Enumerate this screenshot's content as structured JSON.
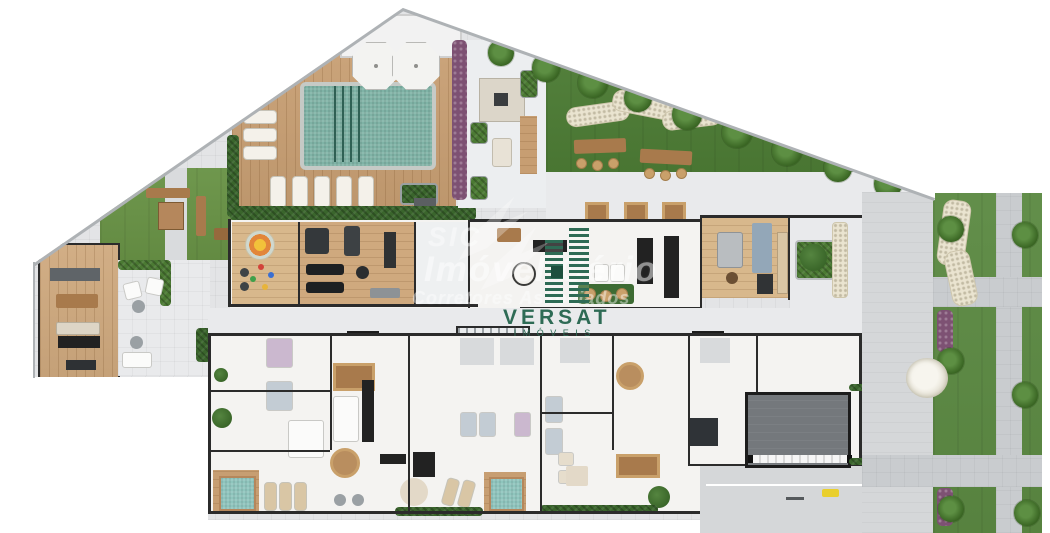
{
  "plan": {
    "watermark": {
      "line1": "SIC",
      "line2": "Imóvel Cério",
      "line3": "Corretores Associados",
      "opacity": "0.45"
    },
    "brand": {
      "name": "VERSAT",
      "subtitle": "I M Ó V E I S",
      "color": "#2e6b55"
    },
    "palette": {
      "paving": "#e3e4e6",
      "terrace": "#e9eaec",
      "lobby": "#eef0f1",
      "deck_wood": "#c79e72",
      "wood_floor": "#cfa97e",
      "wood_floor_light": "#d8b88c",
      "pool_water": "#7fb3a6",
      "plunge_water": "#8fc5bd",
      "lane_line": "#2f6054",
      "lawn": "#699346",
      "lawn_dark": "#4b7a33",
      "street_lawn": "#5c8a43",
      "hedge": "#3a652c",
      "purple_hedge": "#7d5173",
      "room_floor": "#f4f3f1",
      "wall": "#2b2b2b",
      "path_concrete": "#c9cccf",
      "road": "#d5d7d9",
      "ramp_slab": "#74787c",
      "stone_path": "#eae4d0",
      "rug_green": "#3d6b33",
      "rug_blue": "#93a7b8",
      "rug_beige": "#e3d9c8",
      "furniture_dark": "#222222",
      "furniture_wood": "#a87a4c",
      "boundary_line": "#aeb2b5",
      "yellow_marker": "#e9cf2d"
    }
  }
}
